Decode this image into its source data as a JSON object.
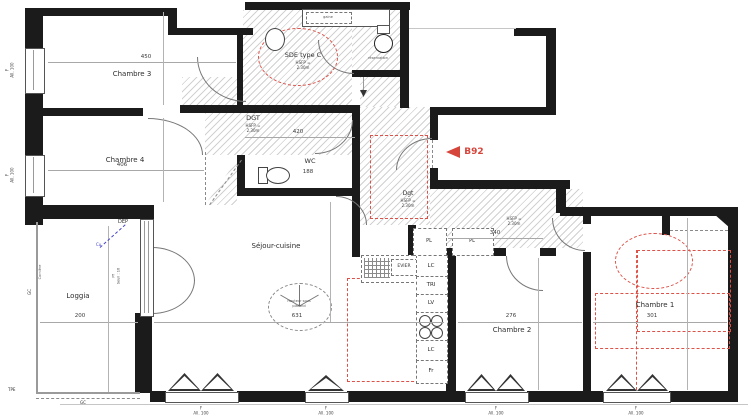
{
  "unit": {
    "label": "B92"
  },
  "rooms": {
    "chambre3": {
      "label": "Chambre 3",
      "dim": "450"
    },
    "chambre4": {
      "label": "Chambre 4",
      "dim": "406"
    },
    "sde": {
      "label": "SDE type C",
      "hsfp": "HSFP =",
      "height": "2.30m"
    },
    "dgt": {
      "label": "DGT",
      "hsfp": "HSFP =",
      "height": "2.30m",
      "dim": "420"
    },
    "wc": {
      "label": "WC",
      "dim": "188"
    },
    "dgt2": {
      "label": "Dgt",
      "hsfp": "HSFP =",
      "height": "2.30m"
    },
    "hall": {
      "hsfp": "HSFP =",
      "height": "2.30m",
      "dim": "340"
    },
    "sejour": {
      "label": "Séjour-cuisine",
      "dim": "631"
    },
    "loggia": {
      "label": "Loggia",
      "dim": "200"
    },
    "chambre2": {
      "label": "Chambre 2",
      "dim": "276"
    },
    "chambre1": {
      "label": "Chambre 1",
      "dim": "301"
    }
  },
  "kitchen": {
    "evier": "EVIER",
    "lc_top": "LC",
    "tri": "TRI",
    "lv": "LV",
    "lc_bottom": "LC",
    "fr": "Fr"
  },
  "closets": {
    "pl_left": "PL",
    "pl_right": "PL"
  },
  "ceiling_note": {
    "line1": "Hauteur sous",
    "line2": "plafond"
  },
  "windows": {
    "type": "F",
    "sill": "All. 100"
  },
  "annotations": {
    "dep": "DEP",
    "cu": "Cu",
    "tpe": "TPE",
    "gc": "GC",
    "pf": "Pf",
    "seuil": "Seuil : 16",
    "corniere": "Cornière",
    "reservation": "réservation",
    "gaine": "gaine"
  },
  "colors": {
    "marker_red": "#d6453a",
    "wall_black": "#1b1b1b",
    "annotation_blue": "#3b3bd1"
  }
}
